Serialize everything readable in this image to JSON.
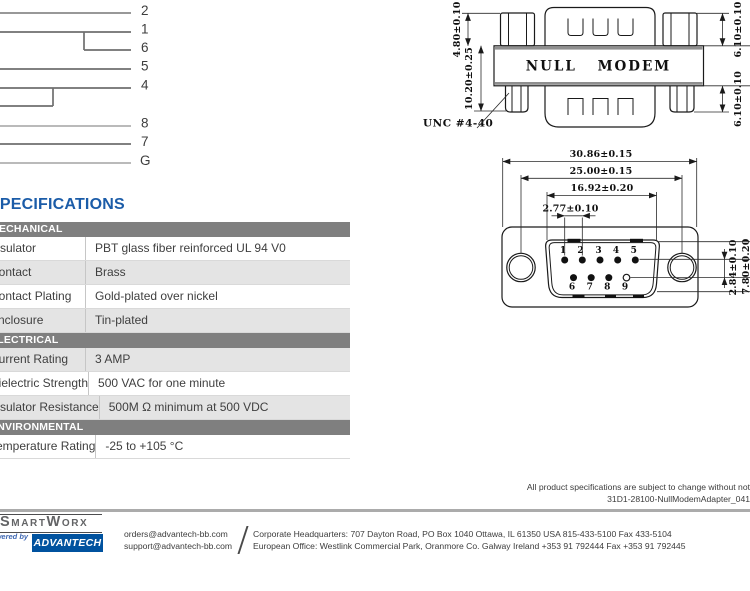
{
  "wiring": {
    "labels": [
      "2",
      "1",
      "6",
      "5",
      "4",
      "8",
      "7",
      "G"
    ]
  },
  "side_view": {
    "body_label": "NULL MODEM",
    "dims": {
      "nut_height": "4.80±0.10",
      "body_height": "10.20±0.25",
      "thread": "UNC #4-40",
      "right_top": "6.10±0.10",
      "right_bottom": "6.10±0.10"
    }
  },
  "front_view": {
    "dims": {
      "outer_width": "30.86±0.15",
      "hole_span": "25.00±0.15",
      "face_width": "16.92±0.20",
      "pin_pitch": "2.77±0.10",
      "row_offset": "2.84±0.10",
      "face_height": "7.80±0.20"
    },
    "pin_labels_top": [
      "1",
      "2",
      "3",
      "4",
      "5"
    ],
    "pin_labels_bottom": [
      "6",
      "7",
      "8",
      "9"
    ]
  },
  "specs": {
    "title": "SPECIFICATIONS",
    "sections": [
      {
        "header": "MECHANICAL",
        "rows": [
          {
            "label": "Insulator",
            "value": "PBT glass fiber reinforced UL 94 V0"
          },
          {
            "label": "Contact",
            "value": "Brass"
          },
          {
            "label": "Contact Plating",
            "value": "Gold-plated over nickel"
          },
          {
            "label": "Enclosure",
            "value": "Tin-plated"
          }
        ]
      },
      {
        "header": "ELECTRICAL",
        "rows": [
          {
            "label": "Current Rating",
            "value": "3 AMP"
          },
          {
            "label": "Dielectric Strength",
            "value": "500 VAC for one minute"
          },
          {
            "label": "Insulator Resistance",
            "value": "500M Ω minimum at 500 VDC"
          }
        ]
      },
      {
        "header": "ENVIRONMENTAL",
        "rows": [
          {
            "label": "Temperature Rating",
            "value": "-25 to +105 °C"
          }
        ]
      }
    ]
  },
  "footer": {
    "disclaimer_line1": "All product specifications are subject to change without not",
    "doc_number": "31D1-28100-NullModemAdapter_041",
    "brand": "SmartWorx",
    "powered_by": "Powered by",
    "advantech_logo": "ADVANTECH",
    "email_orders": "orders@advantech-bb.com",
    "email_support": "support@advantech-bb.com",
    "corporate_line": "Corporate Headquarters: 707 Dayton Road, PO Box 1040 Ottawa, IL 61350 USA   815-433-5100   Fax 433-5104",
    "european_line": "European Office:  Westlink Commercial Park, Oranmore Co. Galway Ireland  +353 91 792444  Fax +353 91 792445"
  },
  "colors": {
    "accent_blue": "#1b5ca8",
    "section_header_gray": "#7f7f7f",
    "row_alt_gray": "#e4e4e4",
    "advantech_blue": "#00529f",
    "powered_by_blue": "#3f68b3"
  }
}
